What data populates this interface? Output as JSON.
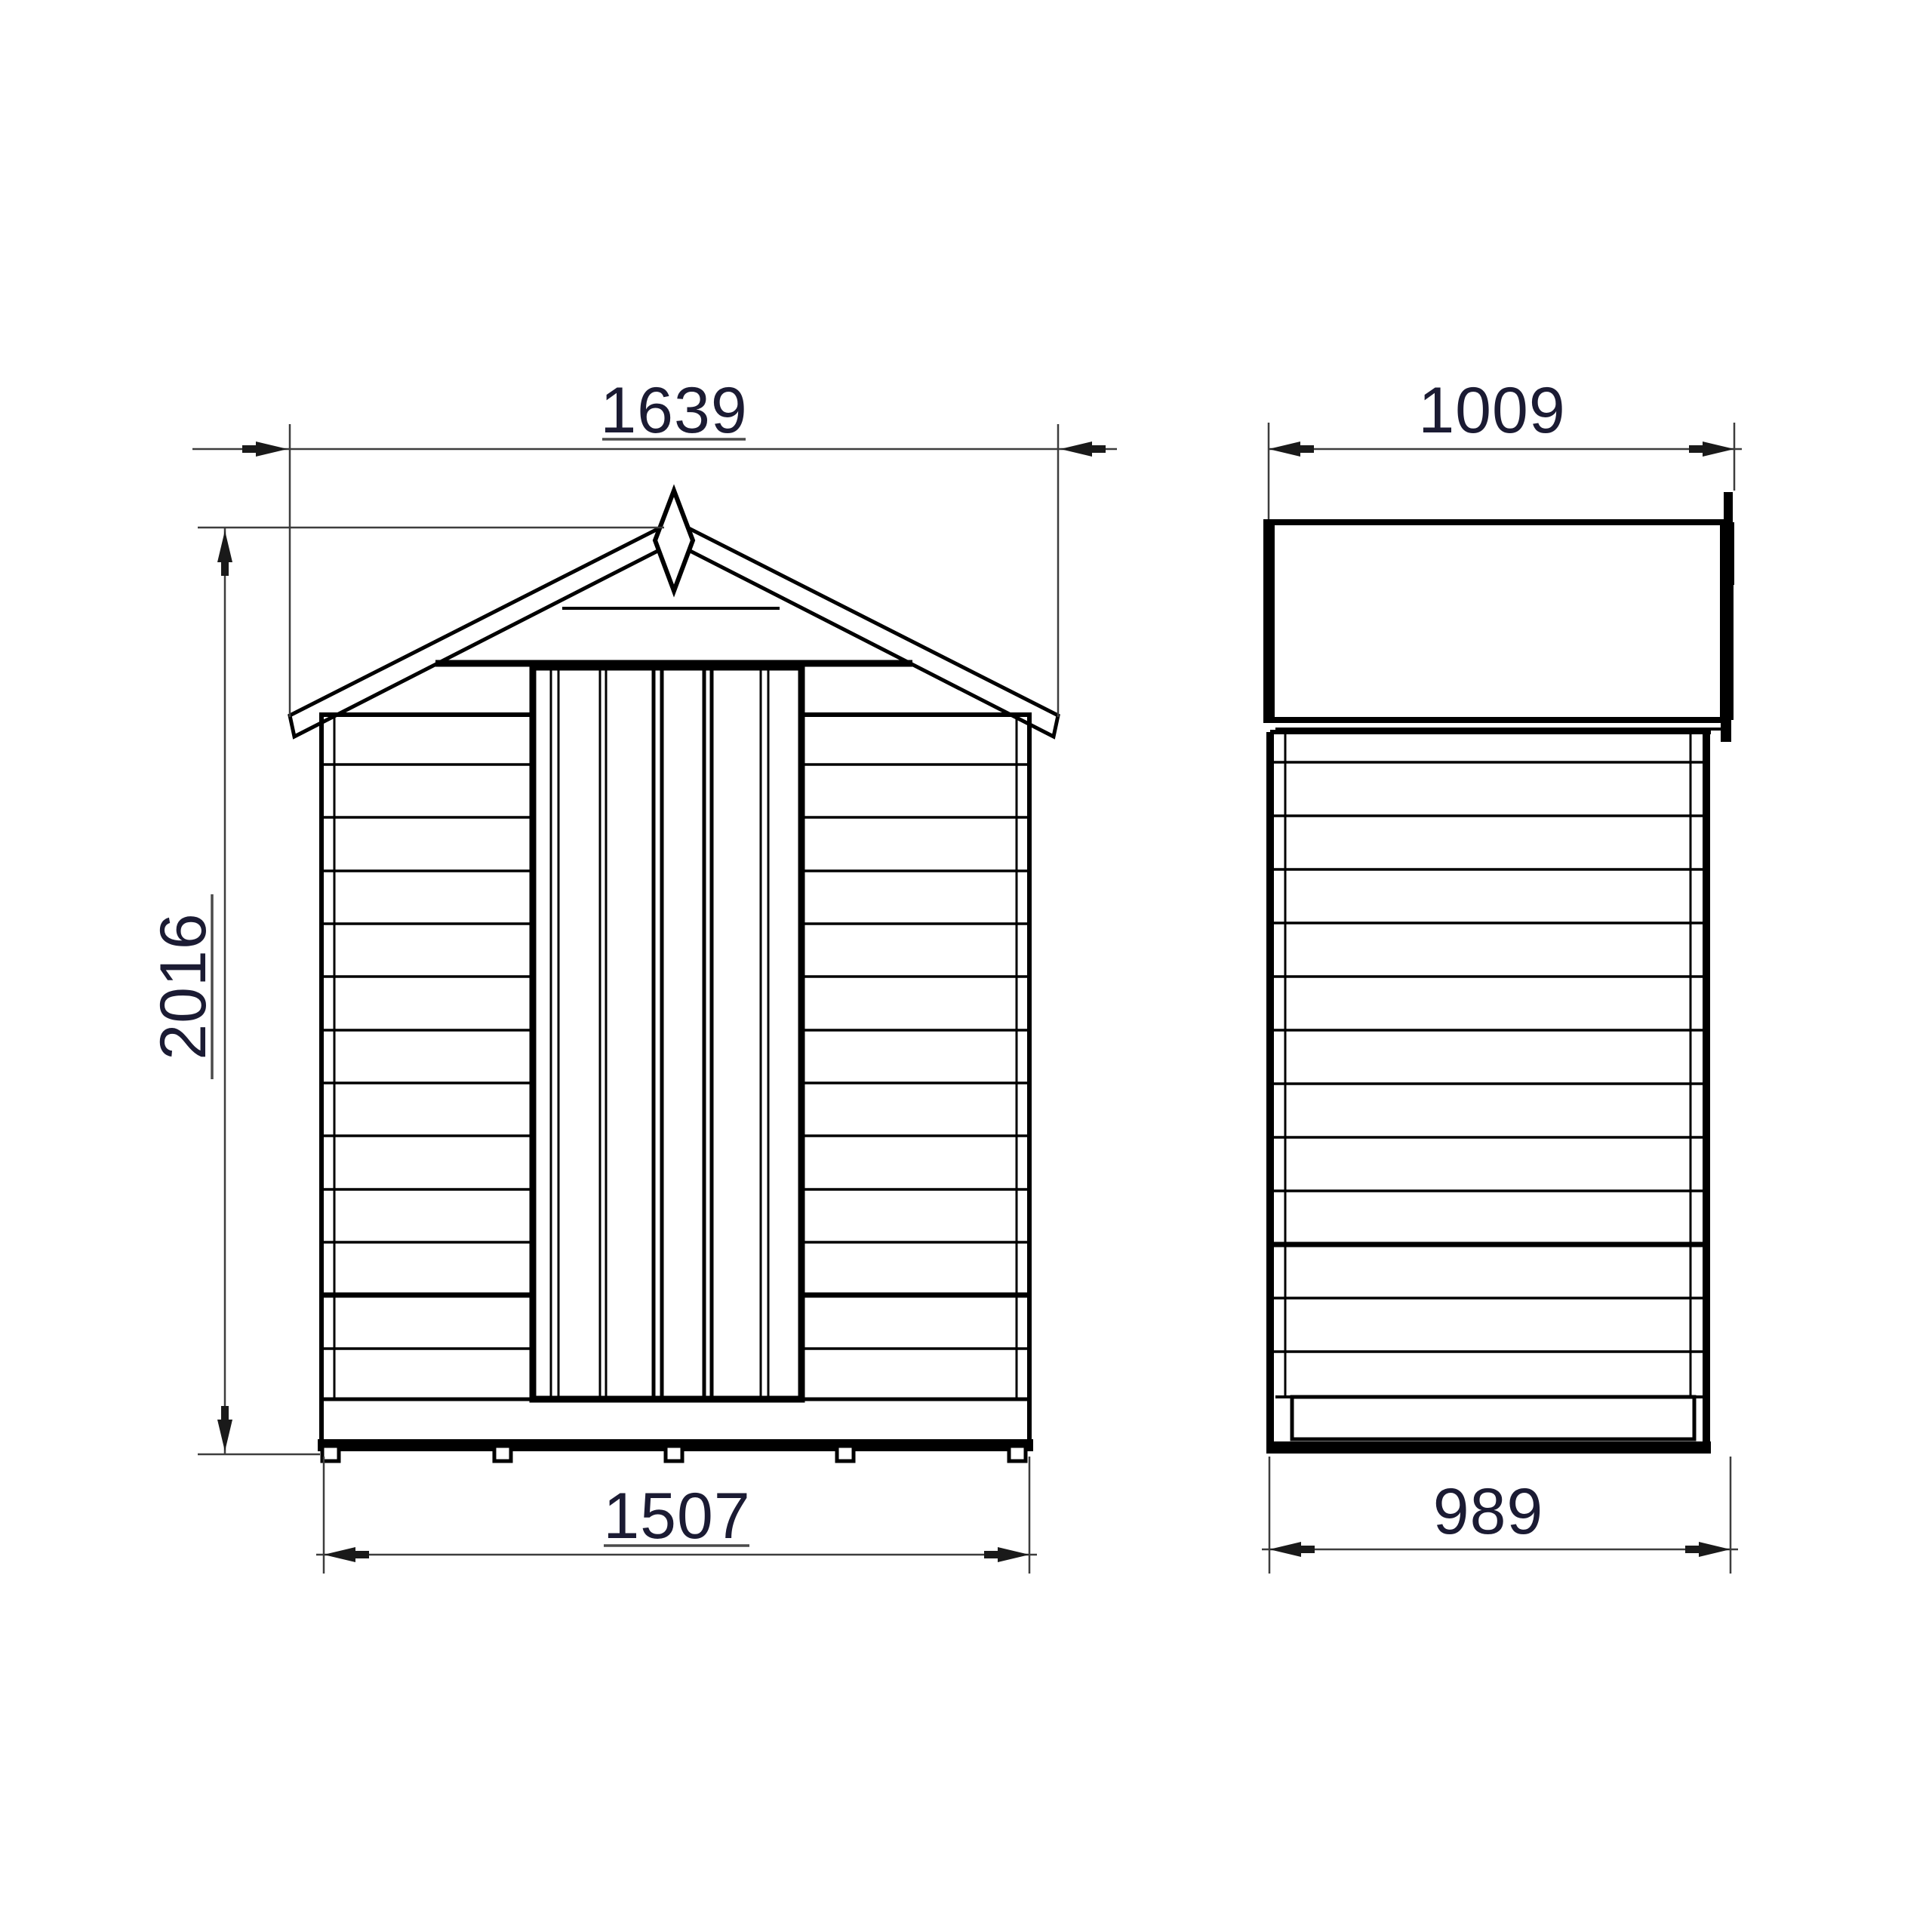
{
  "drawing": {
    "type": "technical-elevation-drawing",
    "subject": "apex-roof garden shed, front and side views",
    "views": {
      "front": {
        "features": [
          "apex roof",
          "diamond finial",
          "braced plank door",
          "overlap cladding",
          "five base feet"
        ]
      },
      "side": {
        "features": [
          "roof slope panel",
          "stepped barge board",
          "overlap cladding",
          "floor bearer"
        ]
      }
    }
  },
  "dims": {
    "roof_width": "1639",
    "height": "2016",
    "base_width": "1507",
    "roof_depth": "1009",
    "base_depth": "989"
  },
  "colors": {
    "background": "#ffffff",
    "structure_line": "#000000",
    "dimension_line": "#3d3d3d",
    "dimension_text": "#1b1b33"
  }
}
